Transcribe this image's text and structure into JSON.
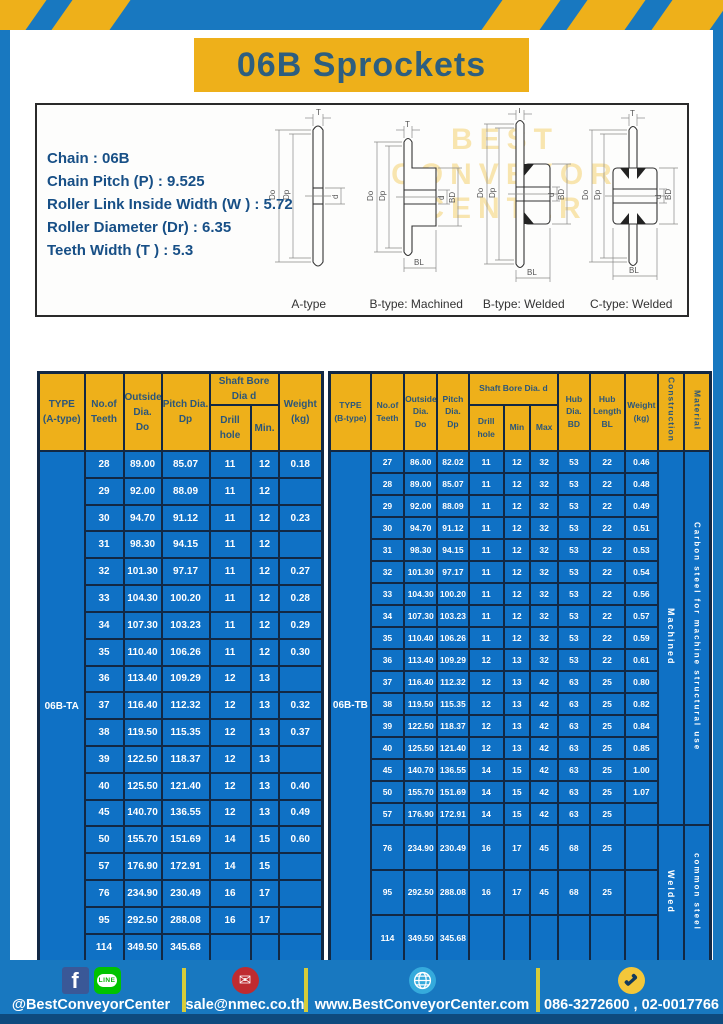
{
  "page": {
    "title": "06B Sprockets"
  },
  "colors": {
    "background_blue": "#1878c0",
    "cell_blue": "#0f71c5",
    "accent_yellow": "#eeb01a",
    "header_text_navy": "#2b567a",
    "border_navy": "#122844",
    "spec_text_navy": "#174f86"
  },
  "specs": {
    "lines": [
      "Chain  : 06B",
      "Chain Pitch (P)  :  9.525",
      "Roller Link Inside Width (W )  :  5.72",
      "Roller Diameter (Dr)  : 6.35",
      "Teeth Width (T )  :  5.3"
    ],
    "dims": {
      "t": "T",
      "do": "Do",
      "dp": "Dp",
      "d": "d",
      "bd": "BD",
      "bl": "BL"
    },
    "diagram_captions": [
      "A-type",
      "B-type: Machined",
      "B-type: Welded",
      "C-type: Welded"
    ],
    "watermark_lines": [
      "BEST",
      "CONVEYOR",
      "CENTER"
    ]
  },
  "table_a": {
    "type_label": "06B-TA",
    "header": {
      "type": [
        "TYPE",
        "(A-type)"
      ],
      "teeth": [
        "No.of",
        "Teeth"
      ],
      "outside": [
        "Outside",
        "Dia.",
        "Do"
      ],
      "pitch": [
        "Pitch Dia.",
        "Dp"
      ],
      "shaft_bore": [
        "Shaft Bore Dia d"
      ],
      "drill": [
        "Drill hole"
      ],
      "min": [
        "Min."
      ],
      "weight": [
        "Weight",
        "(kg)"
      ]
    },
    "merges": [
      {
        "label": "06B-TA",
        "start": 0,
        "span": 19,
        "cls": "type-cell"
      }
    ],
    "rows": [
      [
        "28",
        "89.00",
        "85.07",
        "11",
        "12",
        "0.18"
      ],
      [
        "29",
        "92.00",
        "88.09",
        "11",
        "12",
        ""
      ],
      [
        "30",
        "94.70",
        "91.12",
        "11",
        "12",
        "0.23"
      ],
      [
        "31",
        "98.30",
        "94.15",
        "11",
        "12",
        ""
      ],
      [
        "32",
        "101.30",
        "97.17",
        "11",
        "12",
        "0.27"
      ],
      [
        "33",
        "104.30",
        "100.20",
        "11",
        "12",
        "0.28"
      ],
      [
        "34",
        "107.30",
        "103.23",
        "11",
        "12",
        "0.29"
      ],
      [
        "35",
        "110.40",
        "106.26",
        "11",
        "12",
        "0.30"
      ],
      [
        "36",
        "113.40",
        "109.29",
        "12",
        "13",
        ""
      ],
      [
        "37",
        "116.40",
        "112.32",
        "12",
        "13",
        "0.32"
      ],
      [
        "38",
        "119.50",
        "115.35",
        "12",
        "13",
        "0.37"
      ],
      [
        "39",
        "122.50",
        "118.37",
        "12",
        "13",
        ""
      ],
      [
        "40",
        "125.50",
        "121.40",
        "12",
        "13",
        "0.40"
      ],
      [
        "45",
        "140.70",
        "136.55",
        "12",
        "13",
        "0.49"
      ],
      [
        "50",
        "155.70",
        "151.69",
        "14",
        "15",
        "0.60"
      ],
      [
        "57",
        "176.90",
        "172.91",
        "14",
        "15",
        ""
      ],
      [
        "76",
        "234.90",
        "230.49",
        "16",
        "17",
        ""
      ],
      [
        "95",
        "292.50",
        "288.08",
        "16",
        "17",
        ""
      ],
      [
        "114",
        "349.50",
        "345.68",
        "",
        "",
        ""
      ]
    ]
  },
  "table_b": {
    "type_label": "06B-TB",
    "header": {
      "type": [
        "TYPE",
        "(B-type)"
      ],
      "teeth": [
        "No.of",
        "Teeth"
      ],
      "outside": [
        "Outside",
        "Dia.",
        "Do"
      ],
      "pitch": [
        "Pitch",
        "Dia.",
        "Dp"
      ],
      "shaft_bore": [
        "Shaft Bore Dia.  d"
      ],
      "drill": [
        "Drill hole"
      ],
      "min": [
        "Min"
      ],
      "max": [
        "Max"
      ],
      "hub_dia": [
        "Hub",
        "Dia.",
        "BD"
      ],
      "hub_len": [
        "Hub",
        "Length",
        "BL"
      ],
      "weight": [
        "Weight",
        "(kg)"
      ],
      "construction": "Construction",
      "material": "Material"
    },
    "merges": [
      {
        "label": "06B-TB",
        "start": 0,
        "span": 20,
        "cls": "type-cell"
      }
    ],
    "construction": [
      {
        "label": "Machined",
        "start": 0,
        "span": 17,
        "cls": "con-cell"
      },
      {
        "label": "Welded",
        "start": 17,
        "span": 3,
        "cls": "con-cell"
      }
    ],
    "material": [
      {
        "label": "Carbon  steel  for  machine  structural  use",
        "start": 0,
        "span": 17,
        "cls": "mat-cell"
      },
      {
        "label": "common steel",
        "start": 17,
        "span": 3,
        "cls": "mat-cell"
      }
    ],
    "rows": [
      [
        "27",
        "86.00",
        "82.02",
        "11",
        "12",
        "32",
        "53",
        "22",
        "0.46"
      ],
      [
        "28",
        "89.00",
        "85.07",
        "11",
        "12",
        "32",
        "53",
        "22",
        "0.48"
      ],
      [
        "29",
        "92.00",
        "88.09",
        "11",
        "12",
        "32",
        "53",
        "22",
        "0.49"
      ],
      [
        "30",
        "94.70",
        "91.12",
        "11",
        "12",
        "32",
        "53",
        "22",
        "0.51"
      ],
      [
        "31",
        "98.30",
        "94.15",
        "11",
        "12",
        "32",
        "53",
        "22",
        "0.53"
      ],
      [
        "32",
        "101.30",
        "97.17",
        "11",
        "12",
        "32",
        "53",
        "22",
        "0.54"
      ],
      [
        "33",
        "104.30",
        "100.20",
        "11",
        "12",
        "32",
        "53",
        "22",
        "0.56"
      ],
      [
        "34",
        "107.30",
        "103.23",
        "11",
        "12",
        "32",
        "53",
        "22",
        "0.57"
      ],
      [
        "35",
        "110.40",
        "106.26",
        "11",
        "12",
        "32",
        "53",
        "22",
        "0.59"
      ],
      [
        "36",
        "113.40",
        "109.29",
        "12",
        "13",
        "32",
        "53",
        "22",
        "0.61"
      ],
      [
        "37",
        "116.40",
        "112.32",
        "12",
        "13",
        "42",
        "63",
        "25",
        "0.80"
      ],
      [
        "38",
        "119.50",
        "115.35",
        "12",
        "13",
        "42",
        "63",
        "25",
        "0.82"
      ],
      [
        "39",
        "122.50",
        "118.37",
        "12",
        "13",
        "42",
        "63",
        "25",
        "0.84"
      ],
      [
        "40",
        "125.50",
        "121.40",
        "12",
        "13",
        "42",
        "63",
        "25",
        "0.85"
      ],
      [
        "45",
        "140.70",
        "136.55",
        "14",
        "15",
        "42",
        "63",
        "25",
        "1.00"
      ],
      [
        "50",
        "155.70",
        "151.69",
        "14",
        "15",
        "42",
        "63",
        "25",
        "1.07"
      ],
      [
        "57",
        "176.90",
        "172.91",
        "14",
        "15",
        "42",
        "63",
        "25",
        ""
      ],
      [
        "76",
        "234.90",
        "230.49",
        "16",
        "17",
        "45",
        "68",
        "25",
        ""
      ],
      [
        "95",
        "292.50",
        "288.08",
        "16",
        "17",
        "45",
        "68",
        "25",
        ""
      ],
      [
        "114",
        "349.50",
        "345.68",
        "",
        "",
        "",
        "",
        "",
        ""
      ]
    ]
  },
  "footer": {
    "social_label": "@BestConveyorCenter",
    "line_badge": "LINE",
    "fb_glyph": "f",
    "mail_glyph": "✉",
    "email": "sale@nmec.co.th",
    "website": "www.BestConveyorCenter.com",
    "phones": "086-3272600 , 02-0017766"
  }
}
